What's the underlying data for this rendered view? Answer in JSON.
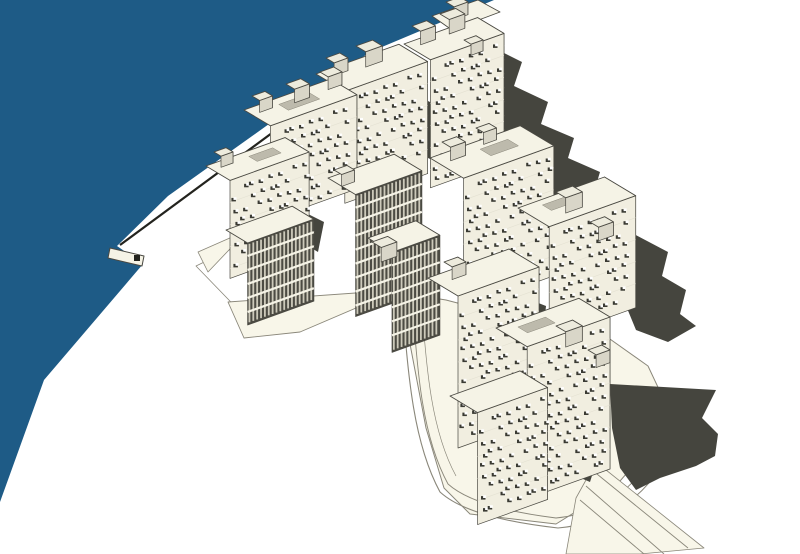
{
  "meta": {
    "description": "Axonometric 3D massing model of a dense waterfront settlement (Kowloon-Walled-City style), line render with cast shadows and harbour water"
  },
  "palette": {
    "background": "#ffffff",
    "water": "#1e5b86",
    "ground": "#f8f6e9",
    "ground_line": "#8a877a",
    "roof": "#f5f3e6",
    "facade": "#f1eee0",
    "facade_shade": "#504f47",
    "stripe_dark": "#4c4b43",
    "stripe_light": "#ccc9ba",
    "slab_light": "#e4e1d2",
    "shadow": "#45453e",
    "cube_top": "#edebdd",
    "cube_left": "#d9d6c8",
    "cube_right": "#b1ae9f",
    "roof_patch": "#bdbaac",
    "window_dark": "#3a3a33",
    "window_light": "#ffffff",
    "outline": "#4a4942",
    "seawall_line": "#23231e"
  },
  "regions": {
    "water": "harbour-water",
    "seawall": "seawall-edge",
    "pier": "pier",
    "ground": "ground-plane-and-roads",
    "shadows": "cast-shadows",
    "buildings": "building-cluster"
  }
}
